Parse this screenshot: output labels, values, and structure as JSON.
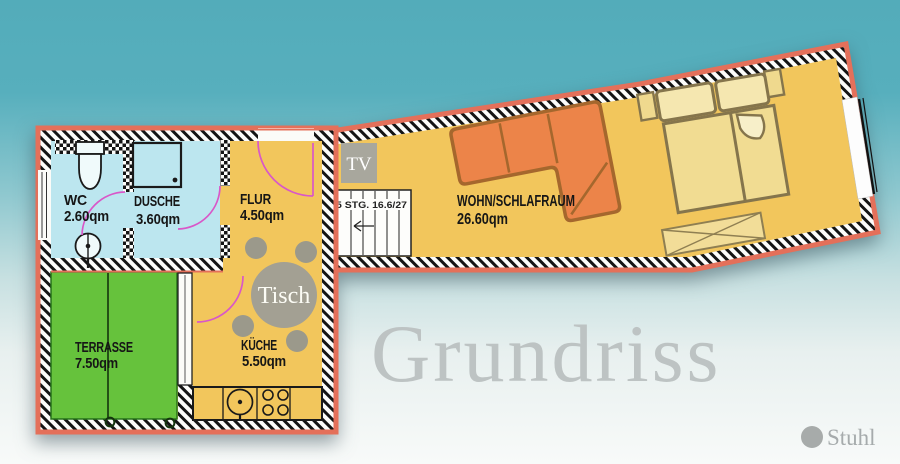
{
  "watermark_title": "Grundriss",
  "rooms": {
    "wc": {
      "name": "WC",
      "area": "2.60qm"
    },
    "dusche": {
      "name": "DUSCHE",
      "area": "3.60qm"
    },
    "flur": {
      "name": "FLUR",
      "area": "4.50qm"
    },
    "wohn_schlafraum": {
      "name": "WOHN/SCHLAFRAUM",
      "area": "26.60qm"
    },
    "terrasse": {
      "name": "TERRASSE",
      "area": "7.50qm"
    },
    "kueche": {
      "name": "KÜCHE",
      "area": "5.50qm"
    }
  },
  "annotations": {
    "tv_label": "TV",
    "table_label": "Tisch",
    "stairs_label": "5 STG. 16.6/27"
  },
  "legend": {
    "chair_label": "Stuhl"
  },
  "colors": {
    "background_top": "#55AEBC",
    "background_bottom": "#F7F9F8",
    "wall_outline": "#E4705A",
    "floor_main": "#F2C65C",
    "floor_bath": "#BCE6EF",
    "floor_terrace": "#66C23C",
    "sofa_orange": "#EC8449",
    "bed_fill": "#F1DC92",
    "furniture_gray": "#A3A093",
    "door_swing_pink": "#D957C8",
    "watermark_gray": "#BDC3C3"
  }
}
